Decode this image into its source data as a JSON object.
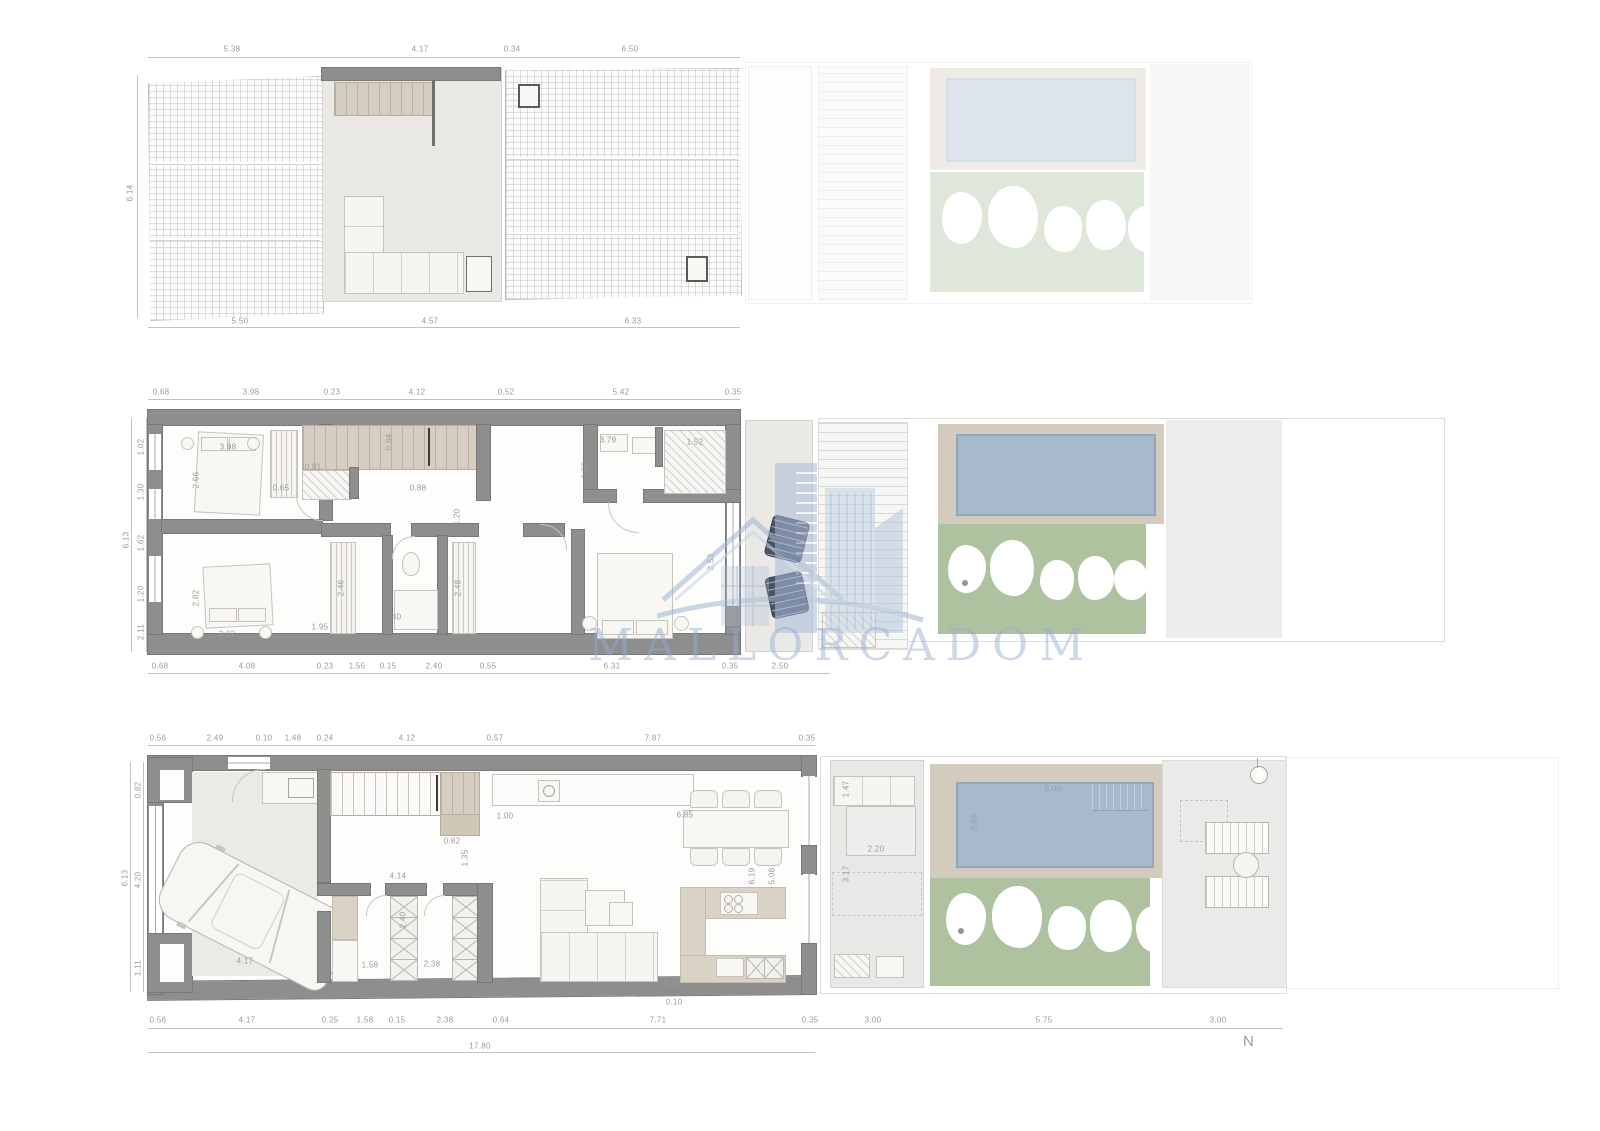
{
  "watermark": {
    "text": "MALLORCADOM",
    "logo": "house-and-skyline-logo"
  },
  "compass": {
    "label": "N"
  },
  "colors": {
    "wall": "#8e8e8e",
    "stair_tan": "#d6cec0",
    "island_tan": "#d9d3c5",
    "pool_blue": "#a7b9cc",
    "lawn_green": "#aec2a0",
    "deck_tan": "#d3ccbe",
    "watermark_blue": "#94aed0",
    "dim_text": "#9a9a9a"
  },
  "plans": {
    "roof": {
      "name": "roof-terrace-plan",
      "dims_top": [
        "5.38",
        "4.17",
        "0.34",
        "6.50"
      ],
      "dims_bottom": [
        "5.50",
        "4.57",
        "6.33"
      ],
      "side_total": "6.14",
      "inner_stair": "1.88"
    },
    "upper": {
      "name": "first-floor-plan",
      "dims_top": [
        "0.68",
        "3.98",
        "0.23",
        "4.12",
        "0.52",
        "5.42",
        "0.35"
      ],
      "dims_bottom": [
        "0.68",
        "4.08",
        "0.23",
        "1.55",
        "0.15",
        "2.40",
        "0.55",
        "6.31",
        "0.35",
        "2.50"
      ],
      "dims_left": [
        "1.02",
        "1.30",
        "1.62",
        "1.20",
        "2.11"
      ],
      "total_left": "6.13",
      "dims_right": [
        "0.97",
        "0.65",
        "0.85",
        "2.33",
        "0.90"
      ],
      "dims_inner": [
        "2.66",
        "3.98",
        "0.91",
        "0.65",
        "0.84",
        "0.88",
        "3.79",
        "1.52",
        "1.52",
        "1.20",
        "2.82",
        "3.02",
        "1.95",
        "2.40",
        "2.46",
        "2.48",
        "3.53"
      ]
    },
    "ground": {
      "name": "ground-floor-plan",
      "dims_top": [
        "0.56",
        "2.49",
        "0.10",
        "1.48",
        "0.24",
        "4.12",
        "0.57",
        "7.87",
        "0.35"
      ],
      "dims_bottom": [
        "0.56",
        "4.17",
        "0.25",
        "1.58",
        "0.15",
        "2.38",
        "0.64",
        "7.71",
        "0.35",
        "3.00",
        "5.75",
        "3.00"
      ],
      "total_bottom": "17.80",
      "dims_left": [
        "0.82",
        "4.20",
        "1.11"
      ],
      "total_left": "6.13",
      "dims_inner": [
        "1.00",
        "6.85",
        "0.82",
        "1.35",
        "4.14",
        "1.58",
        "2.38",
        "6.19",
        "5.08",
        "6.10",
        "4.17",
        "0.10",
        "2.40",
        "2.20",
        "1.47",
        "3.17",
        "5.00",
        "2.50"
      ]
    }
  }
}
